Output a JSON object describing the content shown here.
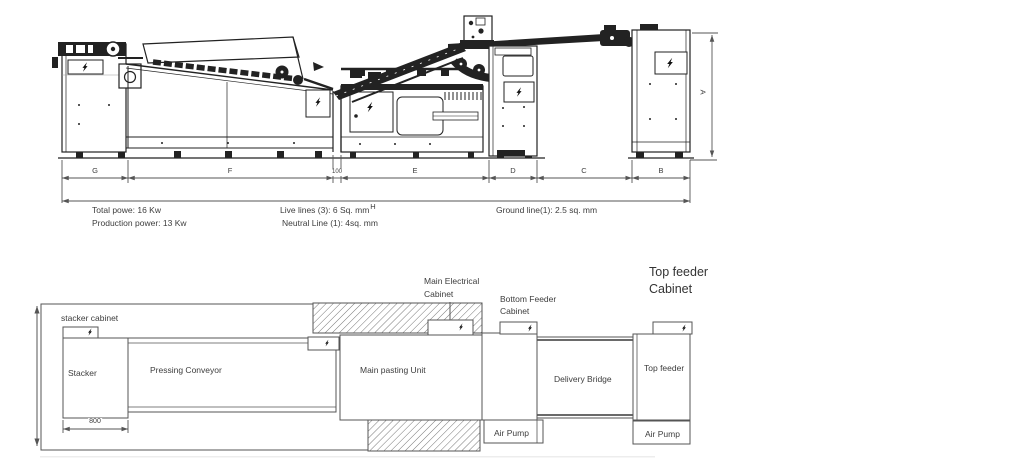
{
  "doc": {
    "type": "machine layout diagram",
    "views": [
      "side elevation with dimensions",
      "floor plan"
    ]
  },
  "icons": {
    "lightning": "lightning-bolt (electrical cabinet marker)"
  },
  "side_view": {
    "dim_labels": {
      "A": "A",
      "B": "B",
      "C": "C",
      "D": "D",
      "E": "E",
      "F": "F",
      "G": "G",
      "H": "H",
      "gap": "100"
    },
    "specs": {
      "total_power": "Total powe: 16 Kw",
      "production_power": "Production power: 13 Kw",
      "live_lines": "Live lines (3): 6 Sq. mm",
      "neutral_line": "Neutral Line (1): 4sq. mm",
      "ground_line": "Ground line(1): 2.5 sq. mm"
    }
  },
  "plan_view": {
    "stacker_cabinet": "stacker cabinet",
    "stacker": "Stacker",
    "stacker_width_mm": "800",
    "pressing_conveyor": "Pressing Conveyor",
    "main_electrical_cabinet": [
      "Main Electrical",
      "Cabinet"
    ],
    "main_pasting_unit": "Main pasting Unit",
    "bottom_feeder_cabinet": [
      "Bottom Feeder",
      "Cabinet"
    ],
    "delivery_bridge": "Delivery Bridge",
    "top_feeder": "Top feeder",
    "top_feeder_cabinet": [
      "Top feeder",
      "Cabinet"
    ],
    "air_pump_left": "Air Pump",
    "air_pump_right": "Air Pump"
  }
}
